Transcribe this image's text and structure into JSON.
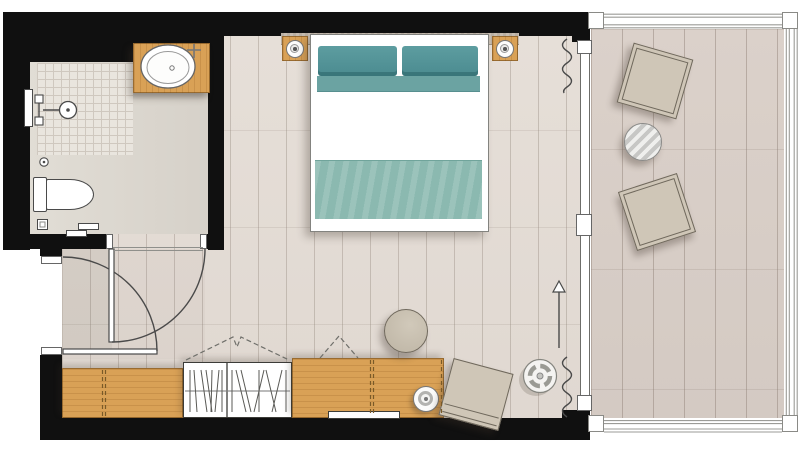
{
  "meta": {
    "title": "Hotel guestroom floor plan",
    "type": "architectural-floor-plan"
  },
  "palette": {
    "wall": "#101010",
    "line": "#4a4a4a",
    "floor-room": "#e4ddd6",
    "floor-balcony": "#d8cec7",
    "floor-bath": "#ddd8d0",
    "tile": "#e9e5de",
    "wood": "#d9a156",
    "wood-edge": "#8a6228",
    "teal-pillow": "#55959b",
    "teal-duvet": "#6ba3a2",
    "teal-blanket": "#8bb9b0",
    "upholstery": "#cfc6b7",
    "uph-edge": "#6f685c",
    "white": "#ffffff"
  },
  "rooms": [
    "bathroom",
    "entry",
    "bedroom",
    "balcony"
  ],
  "furniture": {
    "bathroom": [
      "vanity-counter-basin",
      "shower",
      "wall-hung-toilet",
      "floor-drain"
    ],
    "entry": [
      "entry-door",
      "bathroom-door"
    ],
    "bedroom": [
      "double-bed",
      "nightstand-left",
      "nightstand-right",
      "wardrobe",
      "console",
      "desk",
      "tv",
      "desk-lamp",
      "pouf",
      "lounge-chair",
      "floor-lamp",
      "curtains",
      "swing-direction-arrow"
    ],
    "balcony": [
      "deck-chair-top",
      "deck-chair-bottom",
      "round-side-table",
      "glass-railing"
    ]
  }
}
